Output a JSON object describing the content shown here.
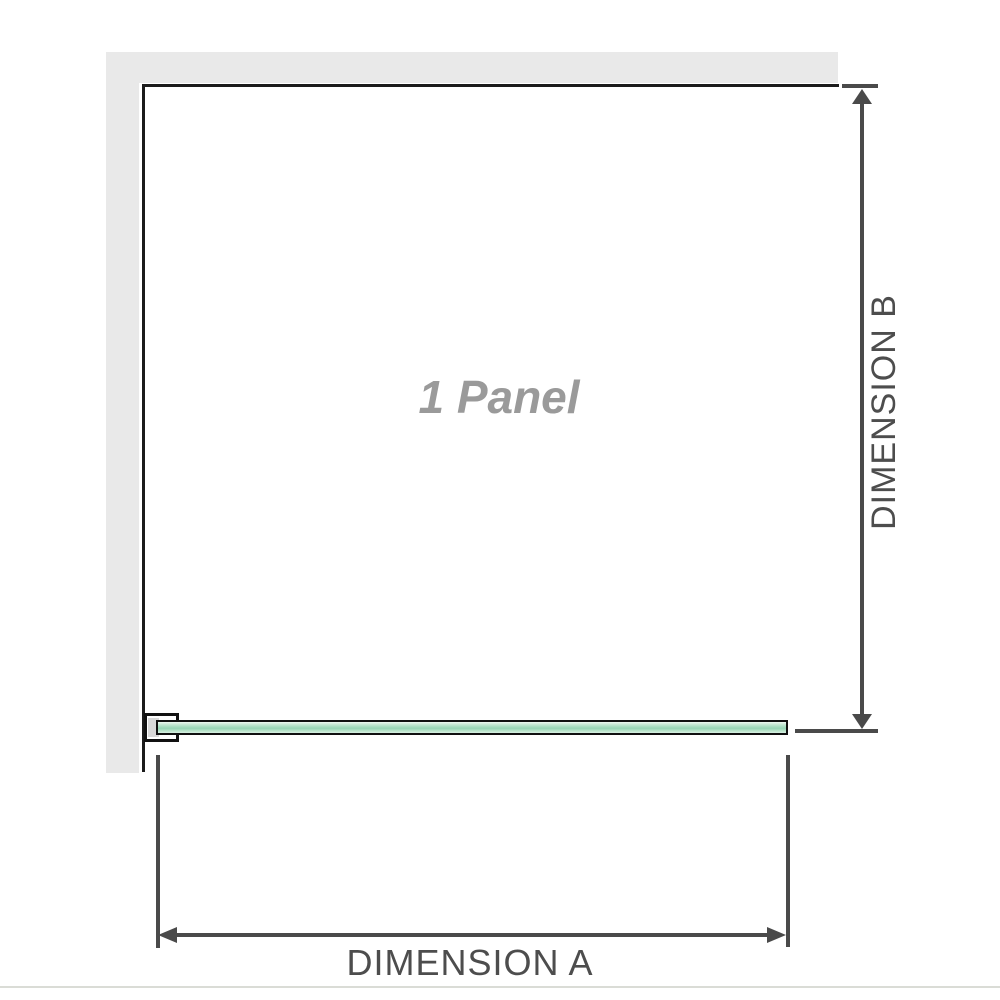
{
  "diagram": {
    "type": "shower-screen-configuration-diagram",
    "panel_label": "1 Panel",
    "panel_count": 1,
    "dimension_a": {
      "label": "DIMENSION A",
      "axis": "horizontal",
      "measures": "panel width"
    },
    "dimension_b": {
      "label": "DIMENSION B",
      "axis": "vertical",
      "measures": "panel height"
    },
    "colors": {
      "wall_fill": "#e9e9e9",
      "panel_outline": "#1b1b1b",
      "dimension_lines": "#4a4a4a",
      "dimension_text": "#4d4d4d",
      "glass_green_main": "#a9ddc1",
      "glass_green_light": "#f0f8f2",
      "glass_border": "#101010",
      "bracket_pad": "#d8d8d8",
      "panel_label_text": "#9a9a9a",
      "bottom_divider": "#dadcd6"
    }
  }
}
